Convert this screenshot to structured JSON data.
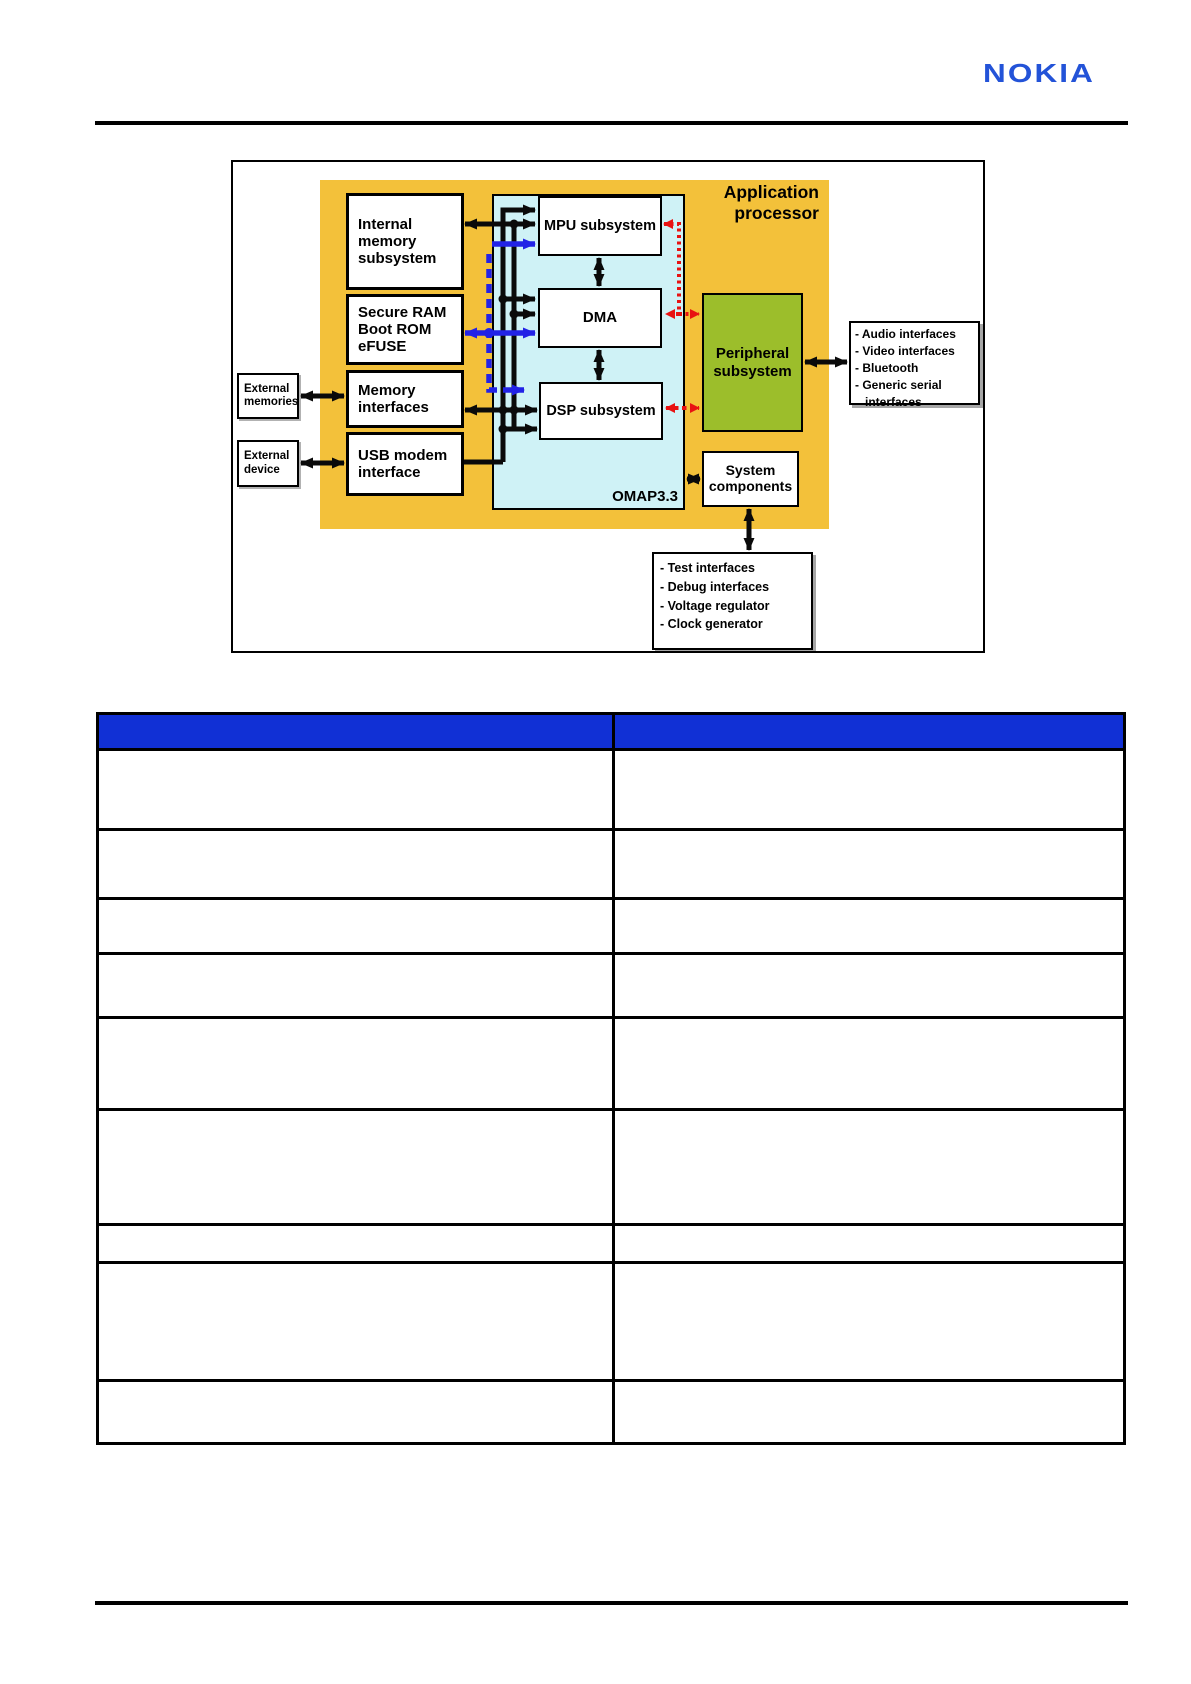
{
  "header": {
    "logo_text": "NOKIA",
    "logo_color": "#2353D8"
  },
  "diagram": {
    "title": "Application\nprocessor",
    "chip_label": "OMAP3.3",
    "blocks": {
      "internal_memory": "Internal\nmemory\nsubsystem",
      "secure_ram": "Secure RAM\nBoot ROM\neFUSE",
      "memory_interfaces": "Memory\ninterfaces",
      "usb_modem": "USB modem\ninterface",
      "mpu": "MPU subsystem",
      "dma": "DMA",
      "dsp": "DSP subsystem",
      "peripheral": "Peripheral\nsubsystem",
      "system_components": "System\ncomponents",
      "external_memories": "External\nmemories",
      "external_device": "External\ndevice"
    },
    "peripheral_interfaces_list": "- Audio interfaces\n- Video interfaces\n- Bluetooth\n- Generic serial\n   interfaces",
    "system_interfaces_list": "- Test interfaces\n- Debug interfaces\n- Voltage regulator\n- Clock generator",
    "colors": {
      "processor_fill": "#F3C13A",
      "interconnect_fill": "#CFF2F6",
      "peripheral_fill": "#9CBE2B",
      "arrow_black": "#0A0A0A",
      "arrow_blue": "#2222E6",
      "arrow_red": "#E81212"
    }
  },
  "table": {
    "header_fill": "#1130D5",
    "columns": [
      "",
      ""
    ],
    "rows": [
      [
        "",
        ""
      ],
      [
        "",
        ""
      ],
      [
        "",
        ""
      ],
      [
        "",
        ""
      ],
      [
        "",
        ""
      ],
      [
        "",
        ""
      ],
      [
        "",
        ""
      ],
      [
        "",
        ""
      ],
      [
        "",
        ""
      ]
    ],
    "row_heights_px": [
      80,
      69,
      55,
      64,
      92,
      115,
      38,
      118,
      63
    ]
  }
}
